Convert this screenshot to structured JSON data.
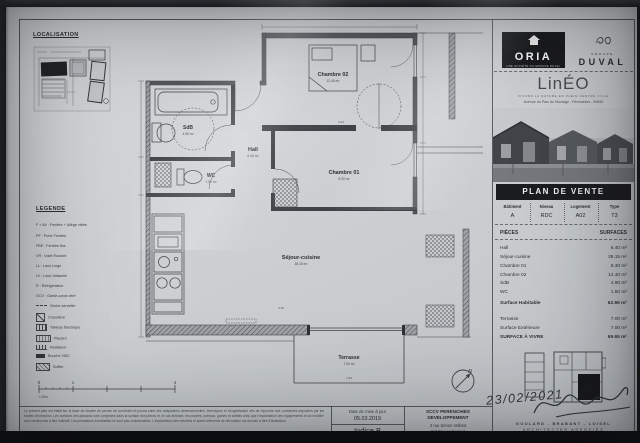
{
  "loc": {
    "title": "LOCALISATION"
  },
  "legend": {
    "title": "LEGENDE",
    "items": [
      "F + AV : Fenêtre + Allège vitrée",
      "PF : Porte Fenêtre",
      "FBE : Fenêtre fixe",
      "VR : Volet Roulant",
      "LL : Lave-Linge",
      "LV : Lave-Vaisselle",
      "R : Réfrigérateur",
      "GCV : Garde-corps vitré"
    ],
    "icons": [
      {
        "label": "Sèche serviette"
      },
      {
        "label": "Chaudière"
      },
      {
        "label": "Tableau Électrique"
      },
      {
        "label": "Placard"
      },
      {
        "label": "Radiateur"
      },
      {
        "label": "Bouche VMC"
      },
      {
        "label": "Soffite"
      }
    ]
  },
  "plan": {
    "rooms": {
      "ch02": {
        "name": "Chambre 02",
        "area": "12.40 m²"
      },
      "ch01": {
        "name": "Chambre 01",
        "area": "9.30 m²"
      },
      "hall": {
        "name": "Hall",
        "area": "6.40 m²"
      },
      "sdb": {
        "name": "SdB",
        "area": "4.90 m²"
      },
      "wc": {
        "name": "WC",
        "area": "1.50 m²"
      },
      "sejour": {
        "name": "Séjour-cuisine",
        "area": "28.15 m²"
      },
      "terrasse": {
        "name": "Terrasse",
        "area": "7.00 m²"
      }
    },
    "dims": [
      "4.21",
      "3.10",
      "1.94"
    ],
    "north": "N",
    "scale": {
      "l0": "0",
      "l1": "1",
      "l4": "4",
      "unit": "1.00m"
    }
  },
  "brand": {
    "oria": {
      "name": "ORIA",
      "tagline": "UNE SOCIÉTÉ DU GROUPE DUVAL"
    },
    "duval": {
      "groupe": "GROUPE",
      "name": "DUVAL"
    },
    "lineo": {
      "name": "LinÉO",
      "subtitle": "VIVONS LA NATURE EN PLEIN CENTRE VILLE",
      "address": "Avenue du Parc du Moulage - Pérenchies - 59840"
    }
  },
  "pdv": {
    "title": "PLAN DE VENTE",
    "unit": {
      "headers": [
        "Bâtiment",
        "Niveau",
        "Logement",
        "Type"
      ],
      "values": [
        "A",
        "RDC",
        "A02",
        "T3"
      ]
    },
    "surfaces": {
      "col_pieces": "PIÈCES",
      "col_surfaces": "SURFACES",
      "rows": [
        {
          "label": "Hall",
          "value": "6.40 m²"
        },
        {
          "label": "Séjour-cuisine",
          "value": "28.15 m²"
        },
        {
          "label": "Chambre 01",
          "value": "9.30 m²"
        },
        {
          "label": "Chambre 02",
          "value": "12.40 m²"
        },
        {
          "label": "SdB",
          "value": "4.90 m²"
        },
        {
          "label": "WC",
          "value": "1.50 m²"
        }
      ],
      "habitable": {
        "label": "Surface Habitable",
        "value": "62.65 m²"
      },
      "ext": [
        {
          "label": "Terrasse",
          "value": "7.00 m²"
        },
        {
          "label": "Surface Extérieure",
          "value": "7.00 m²"
        }
      ],
      "total": {
        "label": "SURFACE À VIVRE",
        "value": "69.65 m²"
      }
    }
  },
  "sign": {
    "date": "23/02/2021",
    "arch_line1": "GOULARD . BRABANT - LOISEL",
    "arch_line2": "ARCHITECTES ASSOCIÉS",
    "arch_line3": "16 rue du Pont Neuf - 59000 Lille"
  },
  "footer": {
    "disclaimer": "Le présent plan est établi sur la base du dossier de permis de construire et pourra subir des adaptations dimensionnelles, techniques et d'organisation afin de répondre aux contraintes imposées par les études d'exécution. Les surfaces des placards sont comprises dans la surface des pièces et, le cas échéant, les poutres, poteaux, gaines et soffites ainsi que l'implantation des équipements et du mobilier sont mentionnés à titre indicatif. Les prestations éventuelles ne sont pas contractuelles. L'implantation des meubles et autres éléments de décoration est donnée à titre d'illustration.",
    "update_label": "Date de mise à jour",
    "update_date": "05.03.2019",
    "indice": "Indice B",
    "sccv_line1": "SCCV PERENCHIES",
    "sccv_line2": "DEVELOPPEMENT",
    "sccv_line3": "3 rue Simon Vollant",
    "sccv_line4": "59130 Lambersart"
  }
}
